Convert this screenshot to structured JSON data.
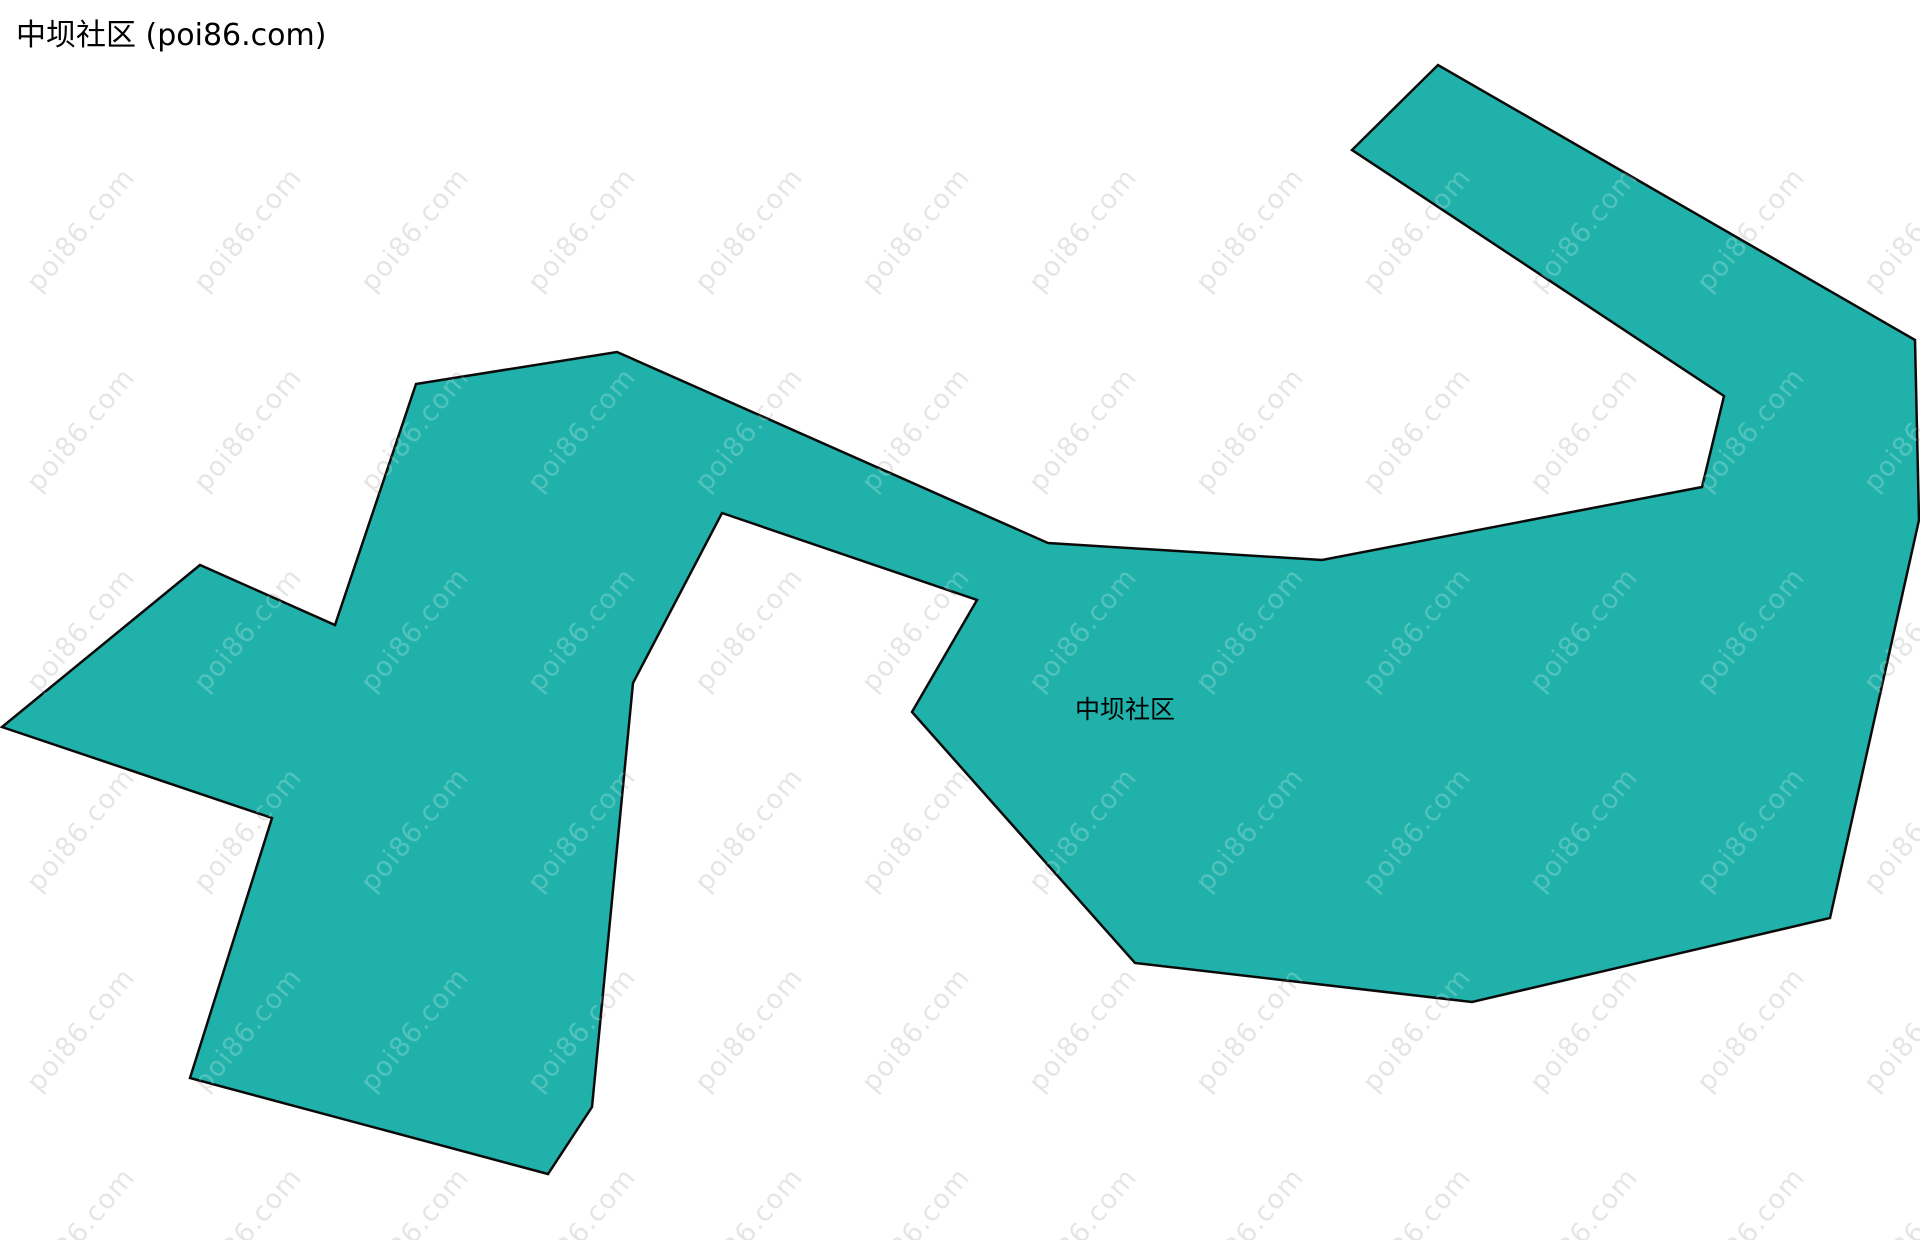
{
  "title": "中坝社区 (poi86.com)",
  "map": {
    "label": {
      "text": "中坝社区",
      "x": 1125,
      "y": 708,
      "font_size": 25,
      "color": "#000000"
    },
    "region": {
      "name": "中坝社区",
      "fill": "#20b2aa",
      "stroke": "#0a0a0a",
      "stroke_width": 2.5,
      "points": [
        [
          617,
          352
        ],
        [
          1048,
          543
        ],
        [
          1322,
          560
        ],
        [
          1702,
          487
        ],
        [
          1724,
          396
        ],
        [
          1352,
          150
        ],
        [
          1438,
          65
        ],
        [
          1915,
          340
        ],
        [
          1919,
          520
        ],
        [
          1830,
          918
        ],
        [
          1472,
          1002
        ],
        [
          1135,
          963
        ],
        [
          912,
          712
        ],
        [
          977,
          600
        ],
        [
          722,
          513
        ],
        [
          633,
          683
        ],
        [
          592,
          1107
        ],
        [
          548,
          1174
        ],
        [
          190,
          1078
        ],
        [
          272,
          818
        ],
        [
          2,
          727
        ],
        [
          200,
          565
        ],
        [
          335,
          625
        ],
        [
          416,
          384
        ]
      ]
    }
  },
  "watermark": {
    "text": "poi86.com",
    "color_on_white": "rgba(0,0,0,0.10)",
    "color_on_region": "rgba(255,255,255,0.22)",
    "font_size": 27,
    "angle_deg": -50,
    "x_start": 81,
    "x_step": 167,
    "y_start": 230,
    "y_step": 200,
    "cols": 12,
    "rows": 6
  }
}
